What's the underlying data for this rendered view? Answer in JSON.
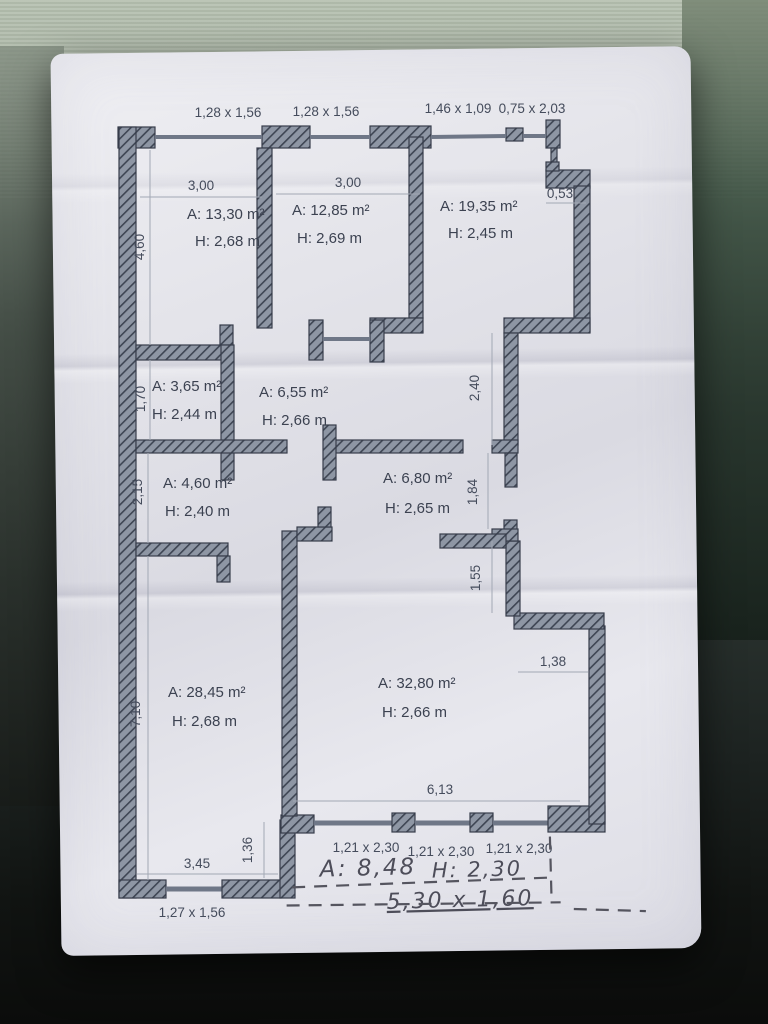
{
  "plan": {
    "windows_top": [
      "1,28 x 1,56",
      "1,28 x 1,56",
      "1,46 x 1,09",
      "0,75 x 2,03"
    ],
    "rooms": [
      {
        "area": "A: 13,30 m²",
        "height": "H: 2,68 m"
      },
      {
        "area": "A: 12,85 m²",
        "height": "H: 2,69 m"
      },
      {
        "area": "A: 19,35 m²",
        "height": "H: 2,45 m"
      },
      {
        "area": "A: 3,65 m²",
        "height": "H: 2,44 m"
      },
      {
        "area": "A: 6,55 m²",
        "height": "H: 2,66 m"
      },
      {
        "area": "A: 4,60 m²",
        "height": "H: 2,40 m"
      },
      {
        "area": "A: 6,80 m²",
        "height": "H: 2,65 m"
      },
      {
        "area": "A: 28,45 m²",
        "height": "H: 2,68 m"
      },
      {
        "area": "A: 32,80 m²",
        "height": "H: 2,66 m"
      }
    ],
    "dims": {
      "room1_width": "3,00",
      "room2_width": "3,00",
      "recess_width": "0,53",
      "left_upper": "4,60",
      "left_hall": "1,70",
      "left_mid": "2,15",
      "left_lower": "7,10",
      "corridor_height": "2,40",
      "hall_opening": "1,84",
      "step_height": "1,55",
      "step_width": "1,38",
      "living_width": "6,13",
      "left_room_width": "3,45",
      "left_step": "1,36"
    },
    "windows_bottom": [
      "1,21 x 2,30",
      "1,21 x 2,30",
      "1,21 x 2,30"
    ],
    "window_bottom_left": "1,27 x 1,56",
    "handwriting": {
      "area": "A: 8,48",
      "height": "H: 2,30",
      "size": "5,30 x 1,60"
    }
  },
  "colors": {
    "paper": "#e4e4ea",
    "wall_fill": "#8e96a4",
    "wall_hatch": "#3e4553",
    "print_ink": "#3c4251",
    "pencil": "#4d4d59",
    "background_top": "#a9b4a5",
    "background_bottom": "#0b0c0b"
  }
}
